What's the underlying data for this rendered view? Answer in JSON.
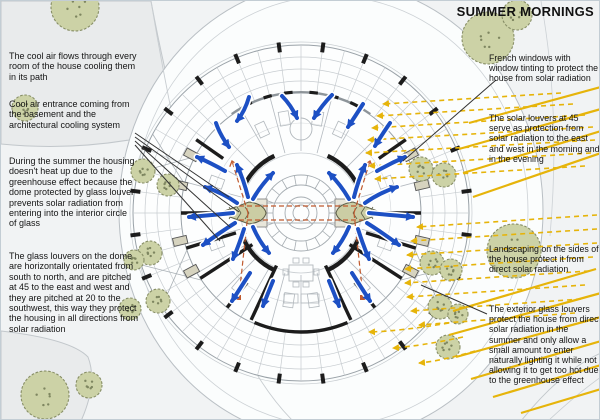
{
  "title": "SUMMER MORNINGS",
  "annotations": {
    "left": [
      {
        "text": "The cool air flows through every room of the house cooling them in its path"
      },
      {
        "text": "Cool air entrance coming from the basement and the architectural cooling system"
      },
      {
        "text": "During the summer the housing doesn't heat up due to the greenhouse effect because the dome protected by glass louver prevents solar radiation from entering into the interior circle of glass"
      },
      {
        "text": "The glass louvers on the dome are horizontally orientated from south to north, and are pitched at 45 to the east and west and they are pitched at 20 to the southwest, this way they protect the housing in all directions from solar radiation"
      }
    ],
    "right": [
      {
        "text": "French windows with window tinting to protect the house from solar radiation"
      },
      {
        "text": "The solar louvers at 45 serve as protection from solar radiation to the east and west in the morning and in the evening"
      },
      {
        "text": "Landscaping on the sides of the house protect it from direct solar radiation"
      },
      {
        "text": "The exterior glass louvers protect the house from direct solar radiation in the summer and only allow a small amount to enter naturally lighting it while not allowing it to get too hot due to the greenhouse effect"
      }
    ]
  },
  "colors": {
    "air_flow_blue": "#1d50c4",
    "solar_yellow": "#e6b40a",
    "heat_red": "#c05a2e",
    "tree_fill": "#ccd2a6",
    "tree_stroke": "#878e66",
    "tree_speckle": "#7e8660",
    "wall_black": "#1c1c1c",
    "plan_line": "#9aa2a8",
    "plan_light": "#c7ccd0",
    "pointer_line": "#333333"
  }
}
